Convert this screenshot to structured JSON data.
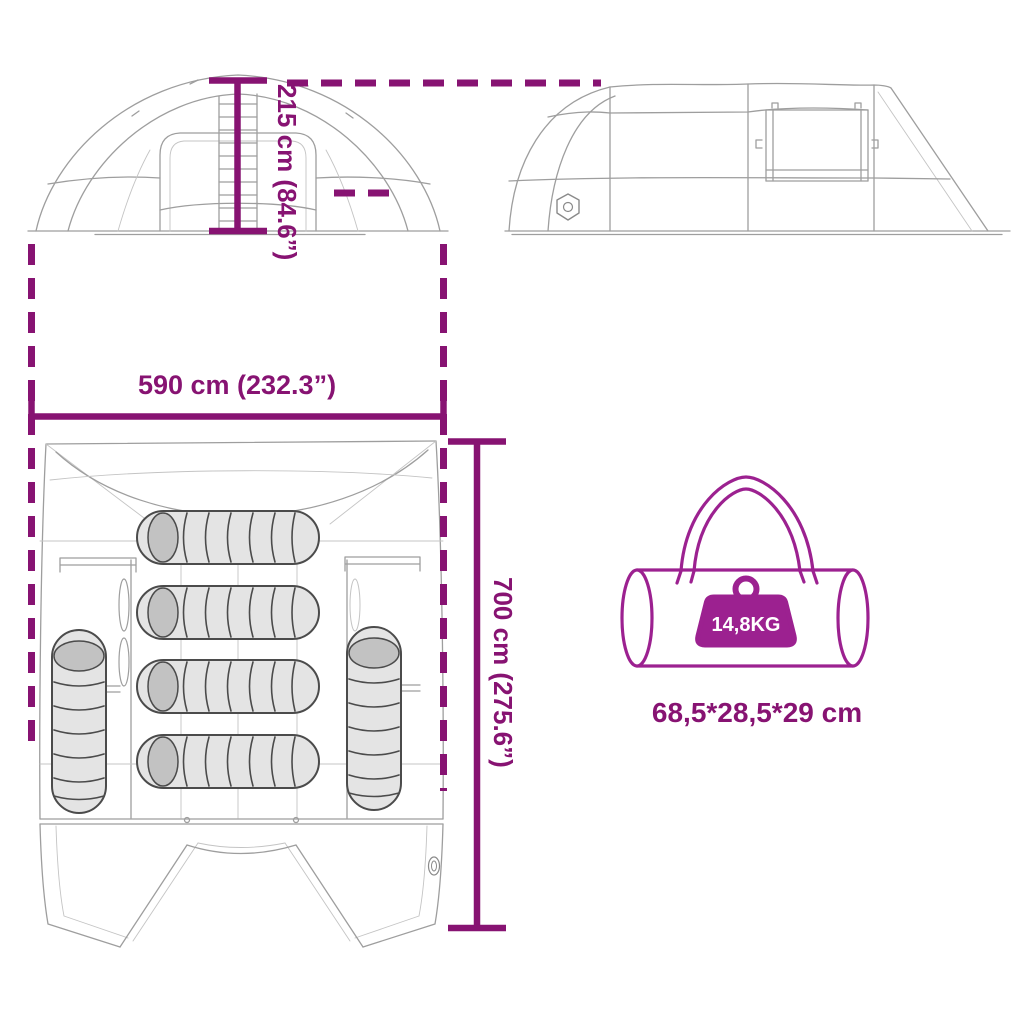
{
  "diagram": {
    "measurements": {
      "height_label": "215 cm (84.6”)",
      "width_label": "590 cm (232.3”)",
      "depth_label": "700 cm (275.6”)"
    },
    "carry_bag": {
      "weight_label": "14,8KG",
      "packed_size_label": "68,5*28,5*29 cm"
    }
  },
  "colors": {
    "measure": "#871372",
    "accent": "#9C2190",
    "lineart": "#9E9E9E",
    "background": "#FFFFFF"
  },
  "icons": {
    "weight": "weight-icon",
    "brand_logo": "brand-logo-icon"
  }
}
